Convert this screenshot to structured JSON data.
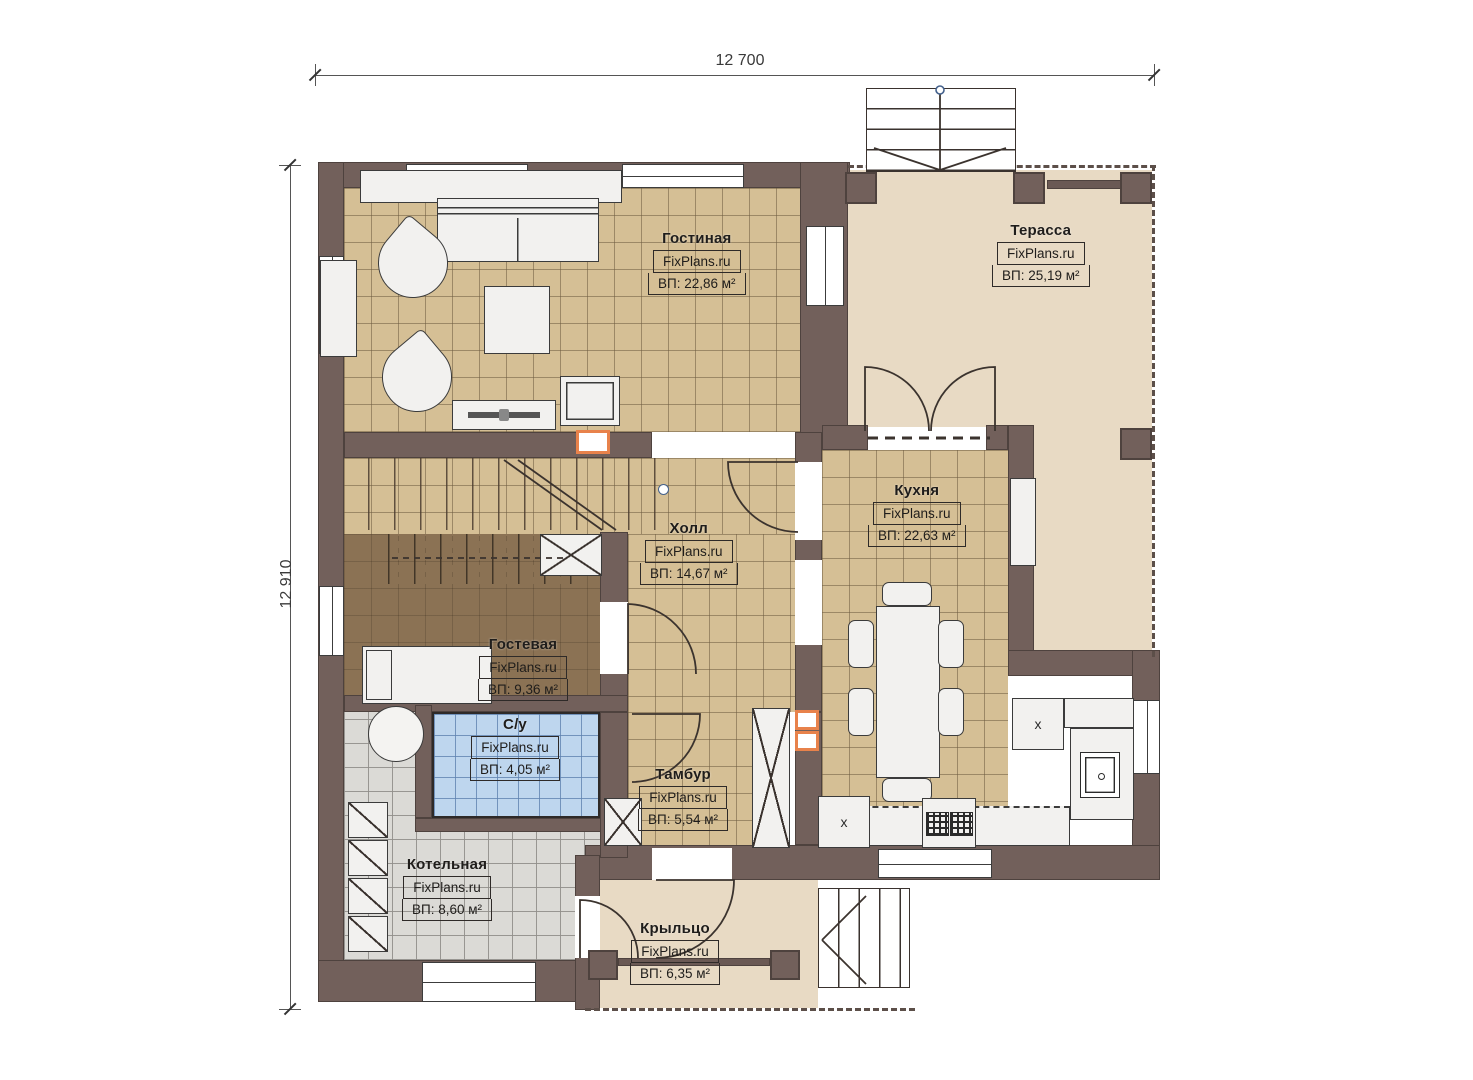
{
  "dimensions": {
    "top": "12 700",
    "left": "12 910"
  },
  "brand": "FixPlans.ru",
  "rooms": [
    {
      "name": "Гостиная",
      "brand": "FixPlans.ru",
      "area": "ВП: 22,86 м²"
    },
    {
      "name": "Терасса",
      "brand": "FixPlans.ru",
      "area": "ВП: 25,19 м²"
    },
    {
      "name": "Кухня",
      "brand": "FixPlans.ru",
      "area": "ВП: 22,63 м²"
    },
    {
      "name": "Холл",
      "brand": "FixPlans.ru",
      "area": "ВП: 14,67 м²"
    },
    {
      "name": "Гостевая",
      "brand": "FixPlans.ru",
      "area": "ВП: 9,36 м²"
    },
    {
      "name": "С/у",
      "brand": "FixPlans.ru",
      "area": "ВП: 4,05 м²"
    },
    {
      "name": "Тамбур",
      "brand": "FixPlans.ru",
      "area": "ВП: 5,54 м²"
    },
    {
      "name": "Котельная",
      "brand": "FixPlans.ru",
      "area": "ВП: 8,60 м²"
    },
    {
      "name": "Крыльцо",
      "brand": "FixPlans.ru",
      "area": "ВП: 6,35 м²"
    }
  ],
  "markers": {
    "cabinet_x_1": "x",
    "cabinet_x_2": "x"
  },
  "colors": {
    "wall": "#72605b",
    "floor_tile": "#d5bf95",
    "terrace": "#e8dac4",
    "bathroom": "#bed6ee",
    "boiler_room": "#dbdad6",
    "guest_floor": "#8b7254",
    "vent_accent": "#e8824b"
  }
}
